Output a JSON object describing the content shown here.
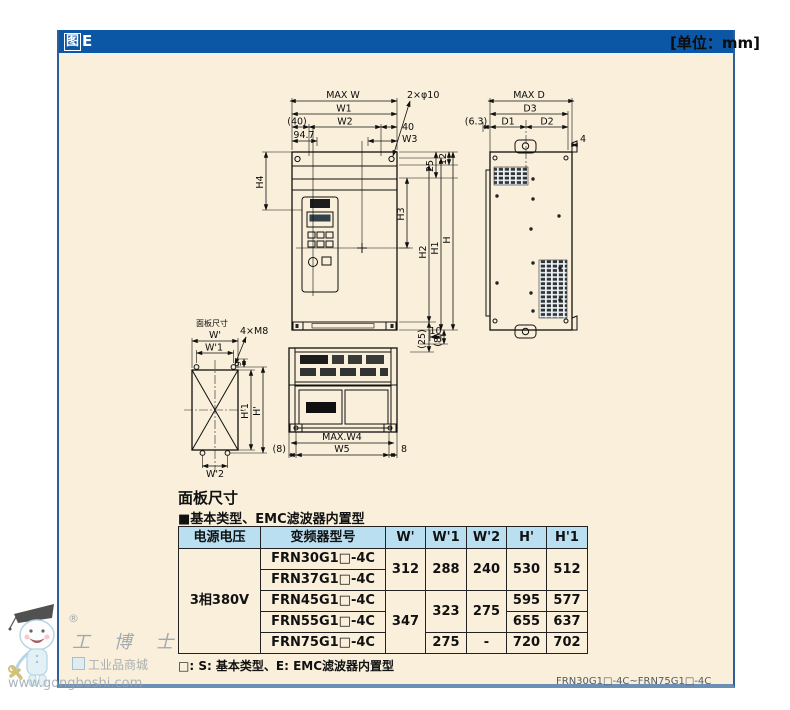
{
  "page": {
    "figure_label_boxed": "图",
    "figure_label_rest": "E",
    "unit": "[单位：mm]",
    "model_range": "FRN30G1□-4C~FRN75G1□-4C"
  },
  "panel_section": {
    "heading": "面板尺寸",
    "subheading": "■基本类型、EMC滤波器内置型",
    "note": "□: S: 基本类型、E: EMC滤波器内置型"
  },
  "table": {
    "headers": [
      "电源电压",
      "变频器型号",
      "W'",
      "W'1",
      "W'2",
      "H'",
      "H'1"
    ],
    "voltage": "3相380V",
    "models": [
      "FRN30G1□-4C",
      "FRN37G1□-4C",
      "FRN45G1□-4C",
      "FRN55G1□-4C",
      "FRN75G1□-4C"
    ],
    "values": {
      "w_30_37": "312",
      "w1_30_37": "288",
      "w2_30_37": "240",
      "h_30_37": "530",
      "h1_30_37": "512",
      "w_45_75": "347",
      "w1_45_55": "323",
      "w2_45_55": "275",
      "h_45": "595",
      "h1_45": "577",
      "h_55": "655",
      "h1_55": "637",
      "w1_75": "275",
      "w2_75": "-",
      "h_75": "720",
      "h1_75": "702"
    }
  },
  "drawing": {
    "front": {
      "max_w": "MAX W",
      "w1": "W1",
      "w2": "W2",
      "p40": "(40)",
      "v947": "94.7",
      "n40": "40",
      "w3": "W3",
      "n25": "25",
      "n12": "12",
      "holes": "2×φ10",
      "h4": "H4",
      "h3": "H3",
      "h2": "H2",
      "h1": "H1",
      "h": "H",
      "n10": "10",
      "p25": "(25)",
      "p8": "(8)"
    },
    "side": {
      "max_d": "MAX D",
      "d3": "D3",
      "d1": "D1",
      "d2": "D2",
      "p63": "(6.3)",
      "n4": "4"
    },
    "bottom": {
      "max_w4": "MAX.W4",
      "w5": "W5",
      "p8": "(8)",
      "n8": "8"
    },
    "cutout": {
      "caption": "面板尺寸",
      "w": "W'",
      "w1": "W'1",
      "w2": "W'2",
      "h": "H'",
      "h1": "H'1",
      "m8": "4×M8",
      "n9": "9"
    }
  },
  "watermark": {
    "reg": "®",
    "brand": "工 博 士",
    "subtitle": "工业品商城",
    "url": "www.gongboshi.com"
  }
}
